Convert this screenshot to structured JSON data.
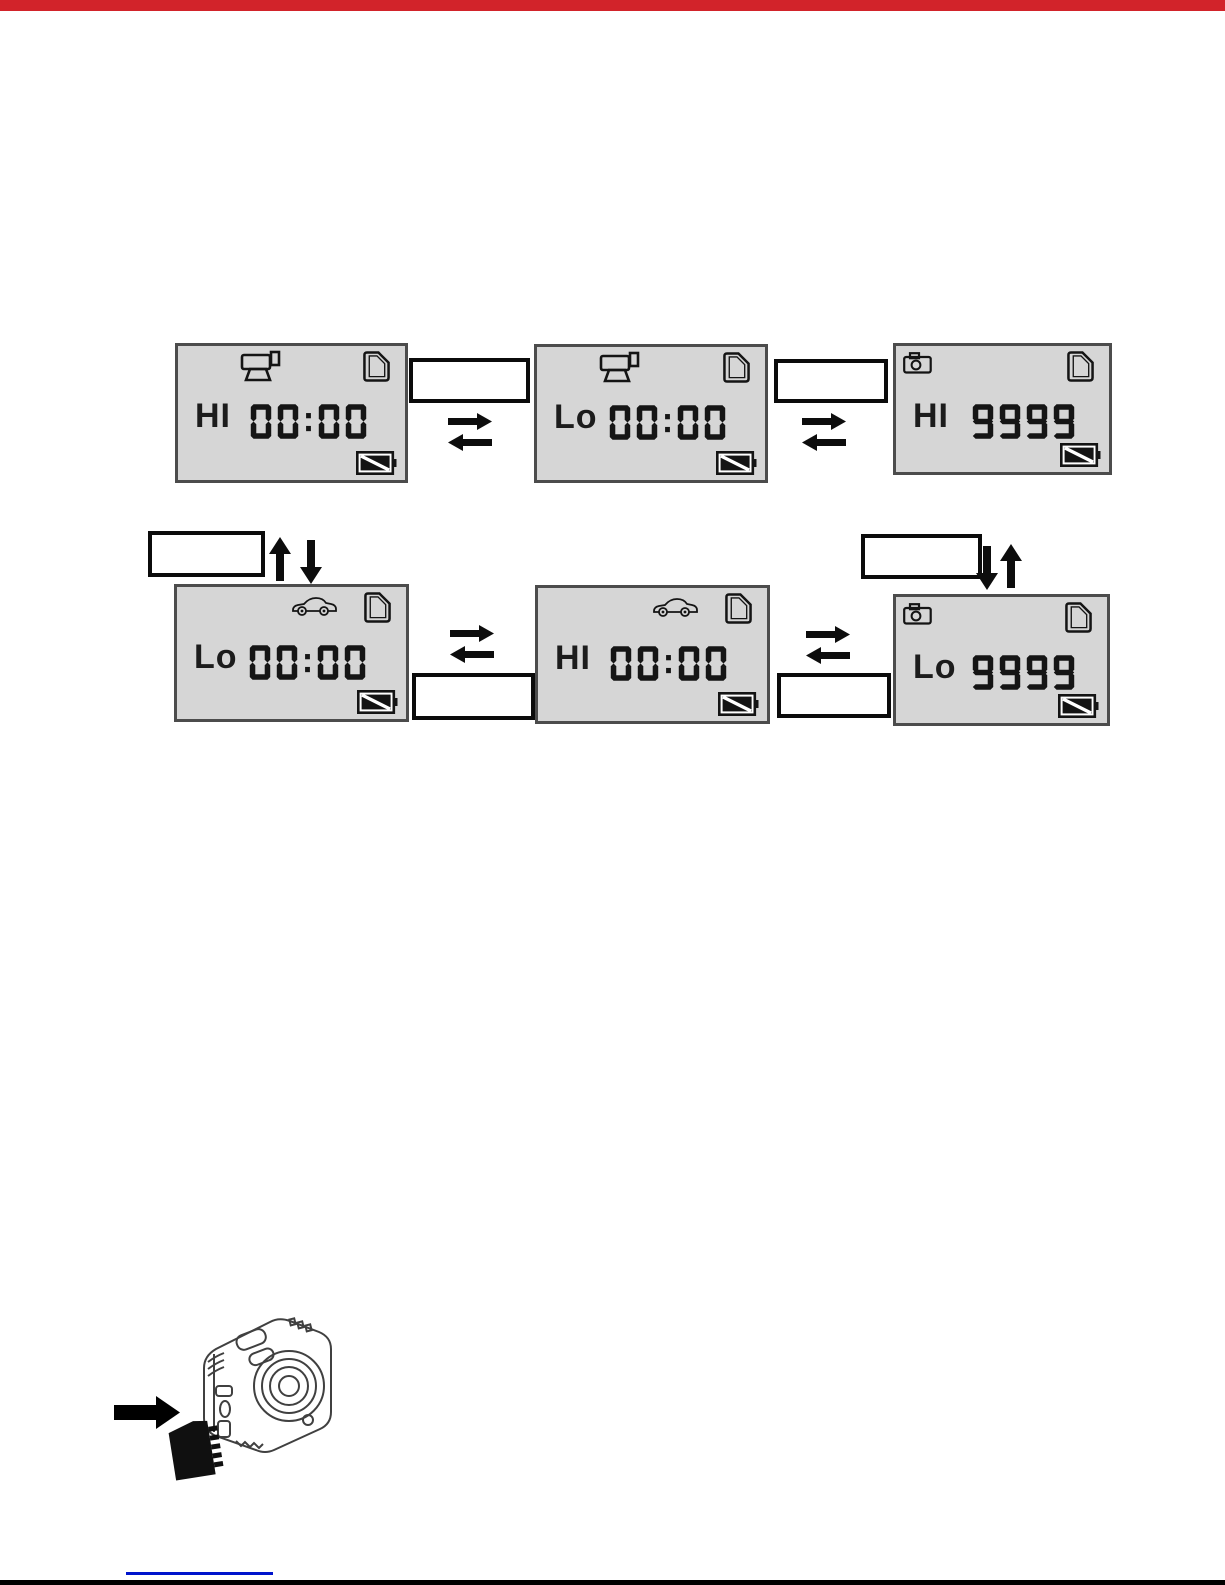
{
  "page": {
    "kind": "camera manual diagram page",
    "top_bar_color": "#d2232a",
    "bottom_bar_color": "#000000",
    "link_underline_color": "#0014cc",
    "lcd_bg_color": "#d6d6d6",
    "ink_color": "#151515"
  },
  "lcd_screens": [
    {
      "name": "video-hi",
      "mode_icon": "video-camera-icon",
      "mode_label": "HI",
      "counter_value": "00:00",
      "sd_icon": "sd-card-icon",
      "battery_icon": "battery-low-icon"
    },
    {
      "name": "video-lo",
      "mode_icon": "video-camera-icon",
      "mode_label": "Lo",
      "counter_value": "00:00",
      "sd_icon": "sd-card-icon",
      "battery_icon": "battery-low-icon"
    },
    {
      "name": "photo-hi",
      "mode_icon": "photo-camera-icon",
      "mode_label": "HI",
      "counter_value": "9999",
      "sd_icon": "sd-card-icon",
      "battery_icon": "battery-low-icon"
    },
    {
      "name": "car-lo",
      "mode_icon": "car-icon",
      "mode_label": "Lo",
      "counter_value": "00:00",
      "sd_icon": "sd-card-icon",
      "battery_icon": "battery-low-icon"
    },
    {
      "name": "car-hi",
      "mode_icon": "car-icon",
      "mode_label": "HI",
      "counter_value": "00:00",
      "sd_icon": "sd-card-icon",
      "battery_icon": "battery-low-icon"
    },
    {
      "name": "photo-lo",
      "mode_icon": "photo-camera-icon",
      "mode_label": "Lo",
      "counter_value": "9999",
      "sd_icon": "sd-card-icon",
      "battery_icon": "battery-low-icon"
    }
  ],
  "callouts": [
    {
      "name": "between-video-hi-and-video-lo",
      "text": ""
    },
    {
      "name": "between-video-lo-and-photo-hi",
      "text": ""
    },
    {
      "name": "left-of-up-down-arrows",
      "text": ""
    },
    {
      "name": "left-of-down-up-arrows-right",
      "text": ""
    },
    {
      "name": "between-car-lo-and-car-hi",
      "text": ""
    },
    {
      "name": "between-car-hi-and-photo-lo",
      "text": ""
    }
  ],
  "connectors": [
    {
      "name": "swap-arrows-video-hi-lo",
      "type": "horizontal-swap"
    },
    {
      "name": "swap-arrows-video-photo",
      "type": "horizontal-swap"
    },
    {
      "name": "up-down-arrows-left",
      "type": "vertical-swap"
    },
    {
      "name": "down-up-arrows-right",
      "type": "vertical-swap"
    },
    {
      "name": "swap-arrows-car-lo-hi",
      "type": "horizontal-swap"
    },
    {
      "name": "swap-arrows-car-photo",
      "type": "horizontal-swap"
    }
  ],
  "illustration": {
    "description": "action camera with microSD card being inserted into side slot",
    "parts": [
      "camera-illustration",
      "microsd-card",
      "insert-arrow"
    ]
  }
}
